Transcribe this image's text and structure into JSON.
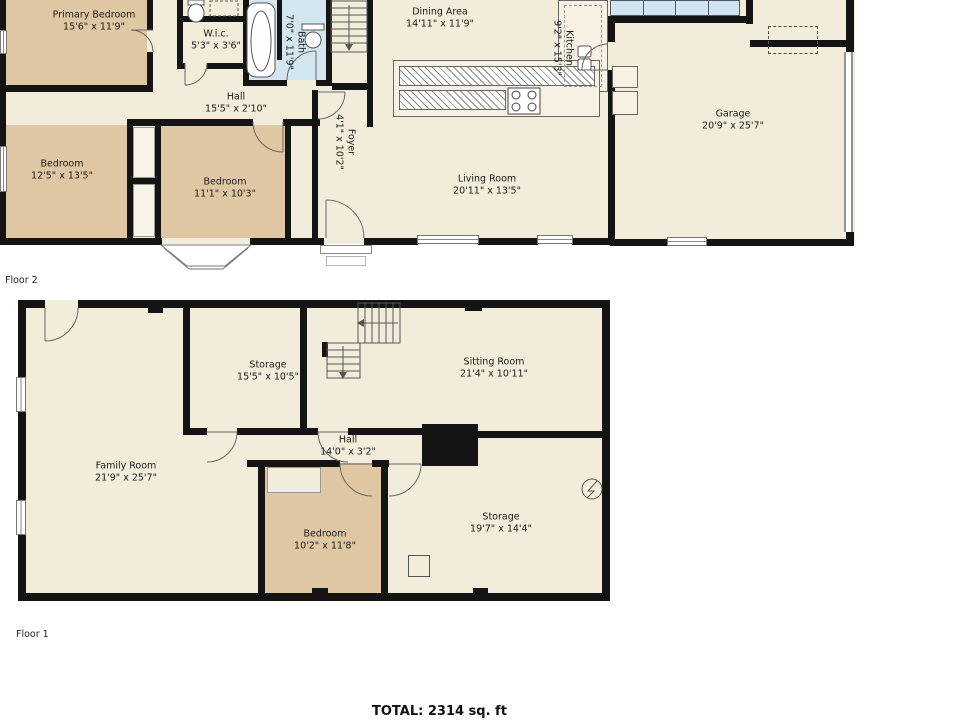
{
  "palette": {
    "wall": "#141414",
    "room_cream": "#f2edda",
    "room_tan": "#dfc7a3",
    "room_blue": "#d3e6f0",
    "background": "#ffffff"
  },
  "floor2": {
    "caption": "Floor 2",
    "rooms": {
      "primary_bedroom": {
        "name": "Primary Bedroom",
        "dims": "15'6\" x 11'9\""
      },
      "wic": {
        "name": "W.i.c.",
        "dims": "5'3\" x 3'6\""
      },
      "bath": {
        "name": "Bath",
        "dims": "7'0\" x 11'9\""
      },
      "hall": {
        "name": "Hall",
        "dims": "15'5\" x 2'10\""
      },
      "dining_area": {
        "name": "Dining Area",
        "dims": "14'11\" x 11'9\""
      },
      "kitchen": {
        "name": "Kitchen",
        "dims": "9'2\" x 15'3\""
      },
      "garage": {
        "name": "Garage",
        "dims": "20'9\" x 25'7\""
      },
      "bedroom_left": {
        "name": "Bedroom",
        "dims": "12'5\" x 13'5\""
      },
      "bedroom_mid": {
        "name": "Bedroom",
        "dims": "11'1\" x 10'3\""
      },
      "foyer": {
        "name": "Foyer",
        "dims": "4'1\" x 10'2\""
      },
      "living_room": {
        "name": "Living Room",
        "dims": "20'11\" x 13'5\""
      }
    }
  },
  "floor1": {
    "caption": "Floor 1",
    "rooms": {
      "storage_upper": {
        "name": "Storage",
        "dims": "15'5\" x 10'5\""
      },
      "sitting_room": {
        "name": "Sitting Room",
        "dims": "21'4\" x 10'11\""
      },
      "family_room": {
        "name": "Family Room",
        "dims": "21'9\" x 25'7\""
      },
      "hall": {
        "name": "Hall",
        "dims": "14'0\" x 3'2\""
      },
      "bedroom": {
        "name": "Bedroom",
        "dims": "10'2\" x 11'8\""
      },
      "storage_lower": {
        "name": "Storage",
        "dims": "19'7\" x 14'4\""
      }
    }
  },
  "footer": {
    "total": "TOTAL: 2314 sq. ft"
  }
}
